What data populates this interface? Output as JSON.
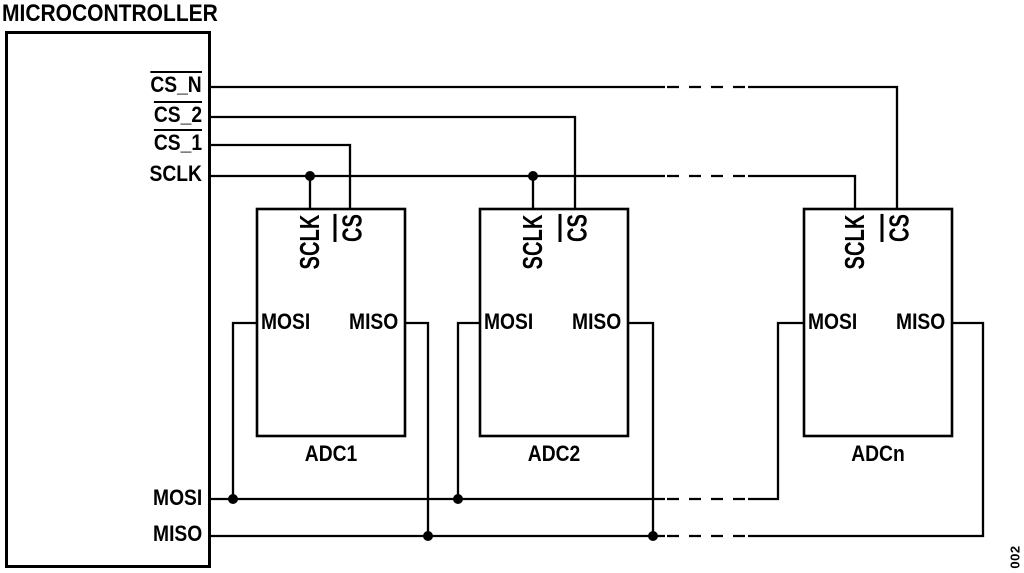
{
  "microcontroller": {
    "title": "MICROCONTROLLER",
    "pin_cs_n": "CS_N",
    "pin_cs_2": "CS_2",
    "pin_cs_1": "CS_1",
    "pin_sclk": "SCLK",
    "pin_mosi": "MOSI",
    "pin_miso": "MISO"
  },
  "adcs": [
    {
      "name": "ADC1",
      "pin_sclk": "SCLK",
      "pin_cs": "CS",
      "pin_mosi": "MOSI",
      "pin_miso": "MISO"
    },
    {
      "name": "ADC2",
      "pin_sclk": "SCLK",
      "pin_cs": "CS",
      "pin_mosi": "MOSI",
      "pin_miso": "MISO"
    },
    {
      "name": "ADCn",
      "pin_sclk": "SCLK",
      "pin_cs": "CS",
      "pin_mosi": "MOSI",
      "pin_miso": "MISO"
    }
  ],
  "active_low_pins": [
    "CS_N",
    "CS_2",
    "CS_1",
    "CS"
  ],
  "figure_code": "002",
  "colors": {
    "line": "#000000",
    "background": "#ffffff",
    "text": "#000000"
  }
}
